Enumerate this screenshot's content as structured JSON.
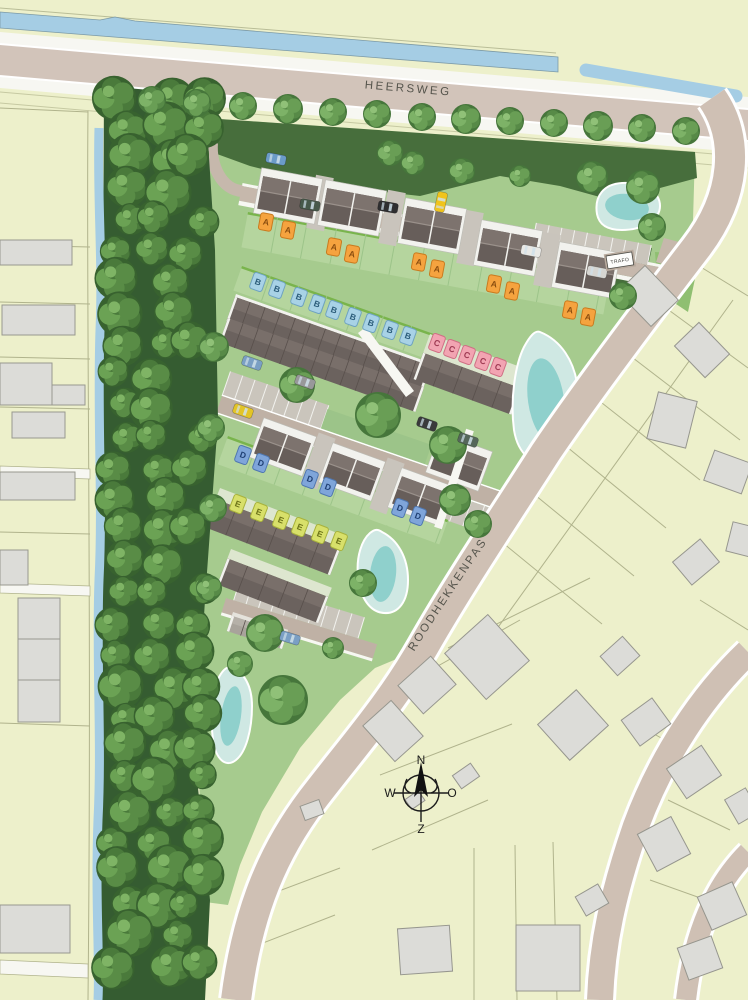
{
  "roads": {
    "heersweg_label": "HEERSWEG",
    "roodhekkenpas_label": "ROODHEKKENPAS"
  },
  "compass": {
    "n": "N",
    "o": "O",
    "z": "Z",
    "w": "W"
  },
  "trafo": {
    "label": "TRAFO"
  },
  "colors": {
    "background": "#edf0cb",
    "water": "#a5cde4",
    "pond_outer": "#cfe8e3",
    "pond_inner": "#8fd0cc",
    "main_road": "#d2c4ba",
    "side_road": "#cfc0b4",
    "site_green": "#a6cb8e",
    "garden_green": "#b5d59e",
    "dark_green": "#476e3c",
    "roof": "#6b625e",
    "existing_building": "#dcdcd8"
  },
  "house_types": [
    {
      "type": "A",
      "fill": "#f5a33f",
      "border": "#c97a1e",
      "text": "#8a4d0f",
      "rot": 10.5,
      "count": 10
    },
    {
      "type": "B",
      "fill": "#a8d2e6",
      "border": "#6fa3c0",
      "text": "#2c5d7a",
      "rot": 19.5,
      "count": 9
    },
    {
      "type": "C",
      "fill": "#f2a4b2",
      "border": "#cf6f84",
      "text": "#9e3a52",
      "rot": 20,
      "count": 5
    },
    {
      "type": "D",
      "fill": "#7fa5da",
      "border": "#4f77b0",
      "text": "#1f3f73",
      "rot": 20,
      "count": 6
    },
    {
      "type": "E",
      "fill": "#d8e06a",
      "border": "#a8b23c",
      "text": "#6b7218",
      "rot": 21,
      "count": 6
    }
  ],
  "markers": [
    {
      "t": "A",
      "x": 266,
      "y": 222
    },
    {
      "t": "A",
      "x": 288,
      "y": 230
    },
    {
      "t": "A",
      "x": 334,
      "y": 247
    },
    {
      "t": "A",
      "x": 352,
      "y": 254
    },
    {
      "t": "A",
      "x": 419,
      "y": 262
    },
    {
      "t": "A",
      "x": 437,
      "y": 269
    },
    {
      "t": "A",
      "x": 494,
      "y": 284
    },
    {
      "t": "A",
      "x": 512,
      "y": 291
    },
    {
      "t": "A",
      "x": 570,
      "y": 310
    },
    {
      "t": "A",
      "x": 588,
      "y": 317
    },
    {
      "t": "B",
      "x": 258,
      "y": 282
    },
    {
      "t": "B",
      "x": 277,
      "y": 289
    },
    {
      "t": "B",
      "x": 299,
      "y": 297
    },
    {
      "t": "B",
      "x": 317,
      "y": 304
    },
    {
      "t": "B",
      "x": 334,
      "y": 310
    },
    {
      "t": "B",
      "x": 353,
      "y": 317
    },
    {
      "t": "B",
      "x": 371,
      "y": 323
    },
    {
      "t": "B",
      "x": 390,
      "y": 330
    },
    {
      "t": "B",
      "x": 408,
      "y": 336
    },
    {
      "t": "C",
      "x": 437,
      "y": 343
    },
    {
      "t": "C",
      "x": 452,
      "y": 349
    },
    {
      "t": "C",
      "x": 467,
      "y": 355
    },
    {
      "t": "C",
      "x": 483,
      "y": 361
    },
    {
      "t": "C",
      "x": 498,
      "y": 367
    },
    {
      "t": "D",
      "x": 243,
      "y": 455
    },
    {
      "t": "D",
      "x": 261,
      "y": 463
    },
    {
      "t": "D",
      "x": 310,
      "y": 479
    },
    {
      "t": "D",
      "x": 328,
      "y": 487
    },
    {
      "t": "D",
      "x": 400,
      "y": 508
    },
    {
      "t": "D",
      "x": 418,
      "y": 516
    },
    {
      "t": "E",
      "x": 238,
      "y": 504
    },
    {
      "t": "E",
      "x": 259,
      "y": 512
    },
    {
      "t": "E",
      "x": 281,
      "y": 520
    },
    {
      "t": "E",
      "x": 300,
      "y": 527
    },
    {
      "t": "E",
      "x": 320,
      "y": 534
    },
    {
      "t": "E",
      "x": 339,
      "y": 541
    }
  ]
}
